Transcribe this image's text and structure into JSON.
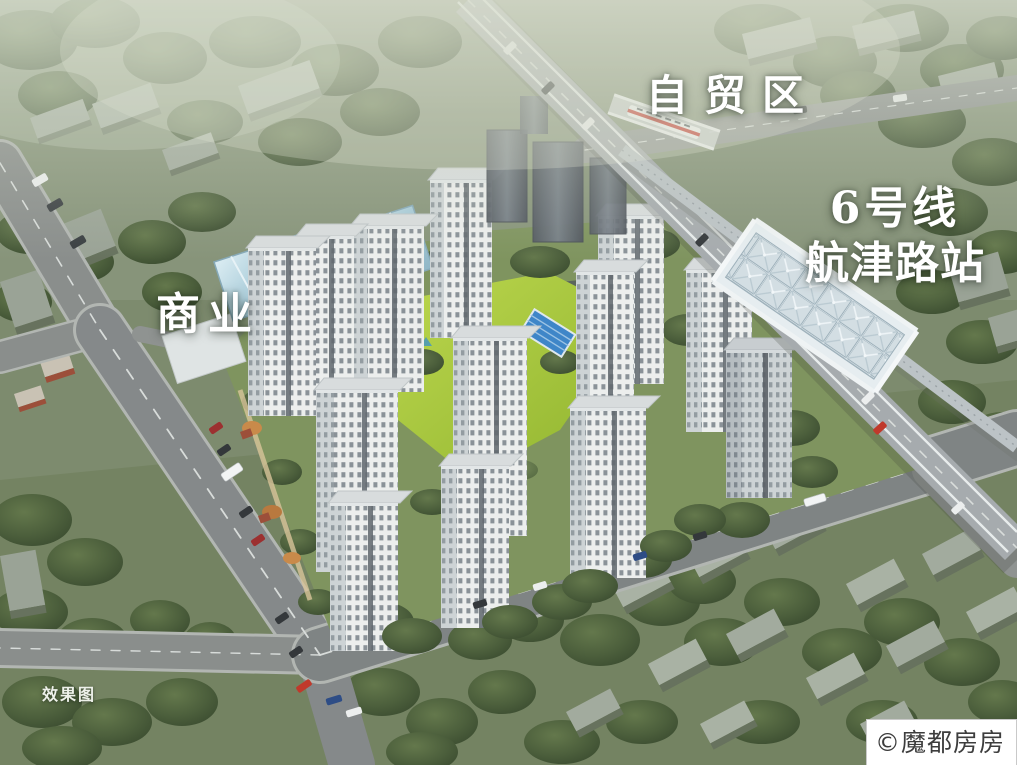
{
  "labels": {
    "free_trade_zone": "自贸区",
    "metro_line": "6号线",
    "metro_station": "航津路站",
    "commercial": "商业",
    "render_caption": "效果图",
    "watermark": "©魔都房房房"
  },
  "colors": {
    "greenery_base": "#7d8b6e",
    "tree_dark": "#46573b",
    "road_gray": "#8a8e8c",
    "tower_white": "#eceeed",
    "lawn_green": "#a8c63e",
    "pool_blue": "#3f86c8",
    "commercial_glass_blue": "#b7d3de",
    "station_glass": "#d3dee3",
    "train_red": "#c8372d",
    "label_text": "#ffffff",
    "watermark_text": "#3d3d3d",
    "watermark_bg": "#ffffff"
  }
}
